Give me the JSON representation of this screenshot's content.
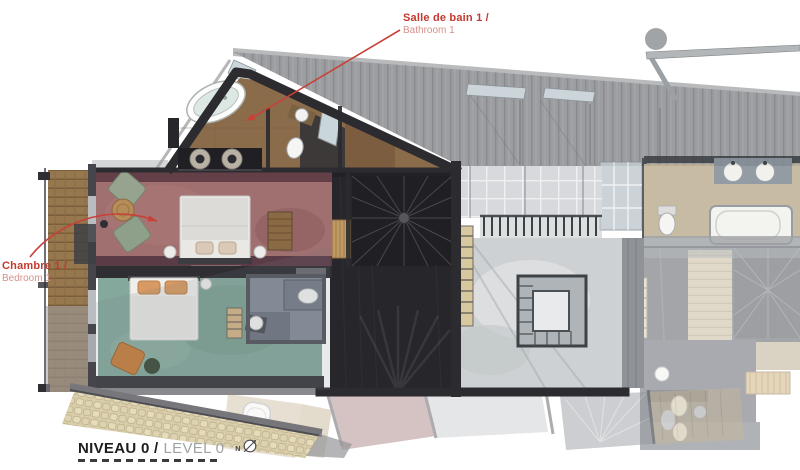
{
  "plan": {
    "callouts": {
      "bathroom": {
        "title": "Salle de bain 1 /",
        "subtitle": "Bathroom 1"
      },
      "bedroom": {
        "title": "Chambre 1 /",
        "subtitle": "Bedroom 1"
      }
    },
    "level_label": {
      "title": "NIVEAU 0 /",
      "subtitle": "LEVEL 0"
    },
    "compass_letter": "N",
    "colors": {
      "accent_red": "#c94038",
      "accent_red_light": "#d4918a",
      "wall_dark": "#2b2b30",
      "cork_floor": "#8b6c4a",
      "bedroom1_carpet": "#a06f6f",
      "bedroom2_carpet": "#85a89c",
      "stair_floor": "#26262b",
      "concrete_floor": "#cdd1d3",
      "tile_floor": "#d7d9dc",
      "balcony_wood": "#96774e",
      "roof_planks": "#9c9da0",
      "shingle_roof": "#d9cdaa",
      "right_bathroom_floor": "#bfb094"
    }
  }
}
